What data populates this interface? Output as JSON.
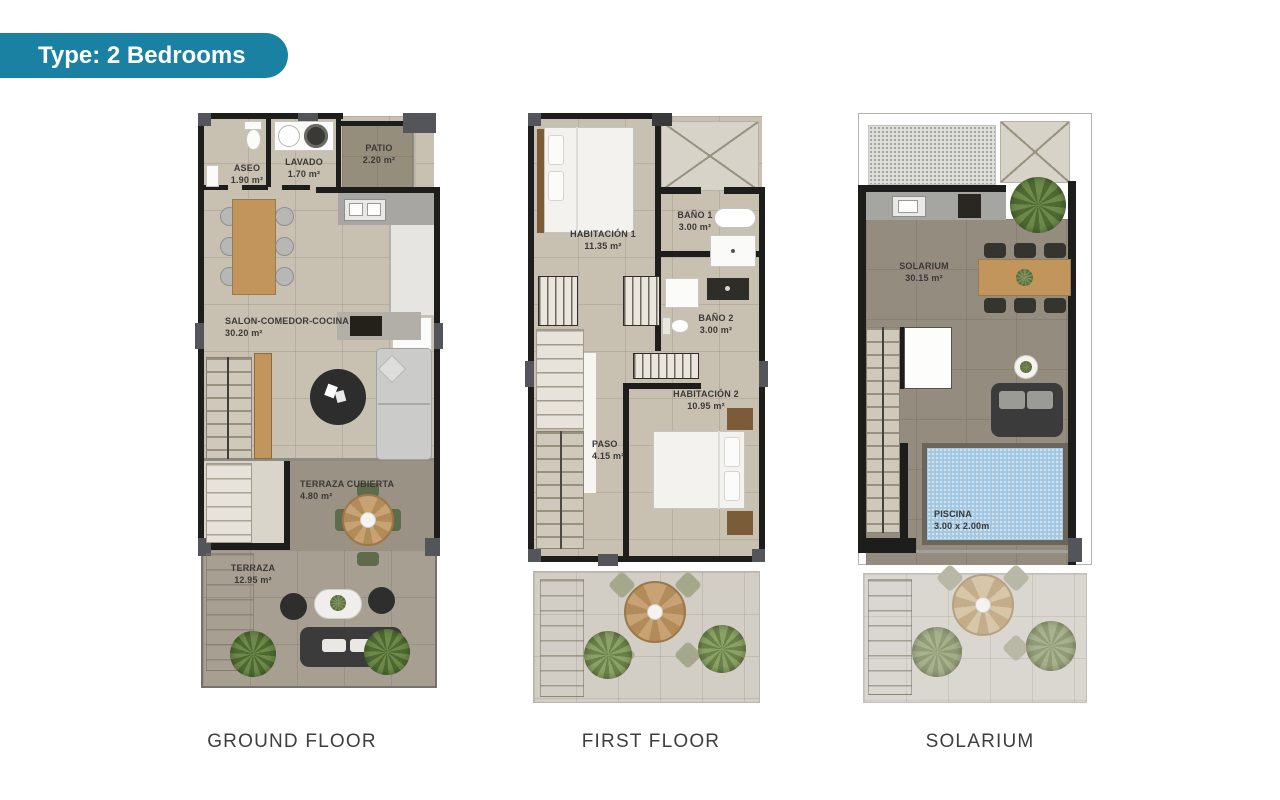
{
  "badge": {
    "label": "Type: 2 Bedrooms",
    "color": "#1a81a2"
  },
  "floors": {
    "ground": {
      "name": "GROUND FLOOR",
      "rooms": {
        "aseo": {
          "label": "ASEO",
          "area": "1.90 m²"
        },
        "lavado": {
          "label": "LAVADO",
          "area": "1.70 m²"
        },
        "patio": {
          "label": "PATIO",
          "area": "2.20 m²"
        },
        "salon": {
          "label": "SALON-COMEDOR-COCINA",
          "area": "30.20 m²"
        },
        "terraza_cubierta": {
          "label": "TERRAZA CUBIERTA",
          "area": "4.80 m²"
        },
        "terraza": {
          "label": "TERRAZA",
          "area": "12.95 m²"
        }
      }
    },
    "first": {
      "name": "FIRST FLOOR",
      "rooms": {
        "habitacion1": {
          "label": "HABITACIÓN 1",
          "area": "11.35 m²"
        },
        "bano1": {
          "label": "BAÑO 1",
          "area": "3.00 m²"
        },
        "bano2": {
          "label": "BAÑO 2",
          "area": "3.00 m²"
        },
        "habitacion2": {
          "label": "HABITACIÓN 2",
          "area": "10.95 m²"
        },
        "paso": {
          "label": "PASO",
          "area": "4.15 m²"
        }
      }
    },
    "solarium": {
      "name": "SOLARIUM",
      "rooms": {
        "solarium": {
          "label": "SOLARIUM",
          "area": "30.15 m²"
        },
        "piscina": {
          "label": "PISCINA",
          "area": "3.00 x 2.00m"
        }
      }
    }
  }
}
